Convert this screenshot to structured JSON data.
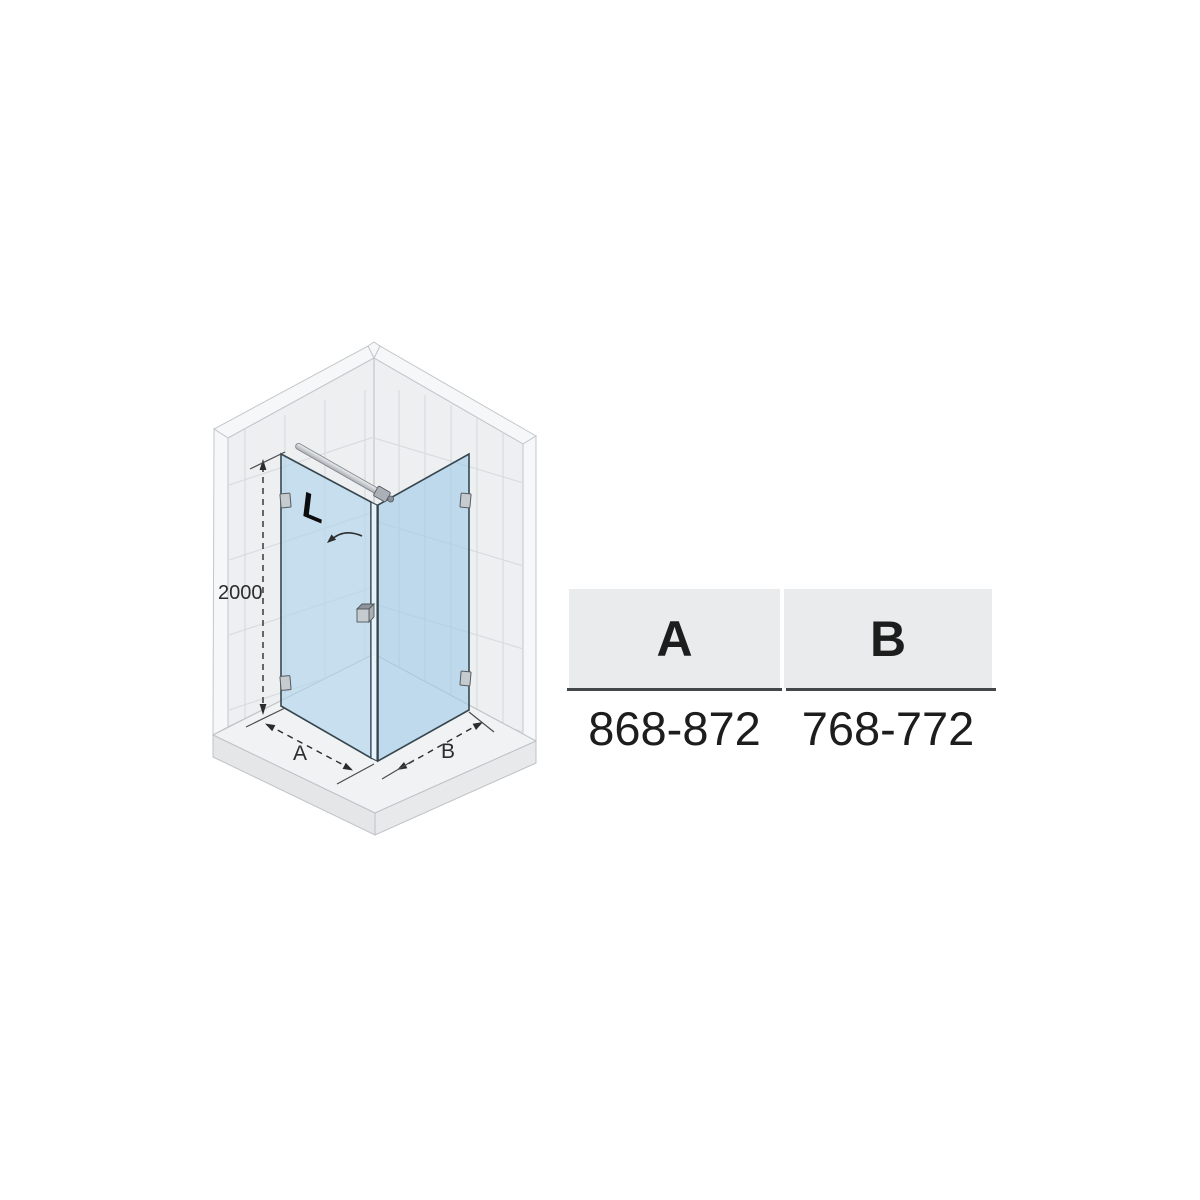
{
  "diagram": {
    "logo_text": "L",
    "height_dimension_mm": "2000",
    "floor_dimension_a_label": "A",
    "floor_dimension_b_label": "B",
    "description": "Isometric corner shower enclosure with hinged door (left) and fixed side panel (right)"
  },
  "table": {
    "columns": [
      {
        "header": "A",
        "value": "868-872"
      },
      {
        "header": "B",
        "value": "768-772"
      }
    ]
  },
  "colors": {
    "wall": "#edeff1",
    "wall-edge": "#f6f7f8",
    "wall-line": "#c3c7ca",
    "tile-line": "#d9dcdf",
    "tray": "#f1f2f3",
    "tray-front": "#e4e6e8",
    "glass": "#aed4ec",
    "glass-2": "#9fcbe6",
    "glass-edge-band": "#e6f4fb",
    "outline": "#37474f",
    "metal": "#c6cbd0",
    "dim": "#2c2c2c",
    "logo": "#0d0d0d",
    "table-header-bg": "#e9ebec",
    "table-line": "#43474a",
    "text": "#1d1d1d"
  }
}
